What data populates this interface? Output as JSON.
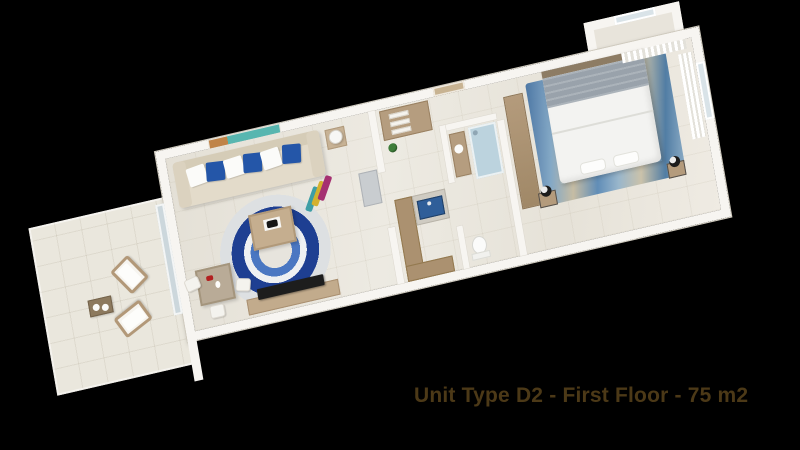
{
  "caption": {
    "text": "Unit Type D2 - First Floor - 75 m2"
  },
  "palette": {
    "background": "#000000",
    "wall": "#f7f5f1",
    "floor": "#e8e4db",
    "terrace_floor": "#eae7dd",
    "wood": "#b59d7f",
    "glass": "#ccd7dc",
    "accent_blue": "#2456a8",
    "rug_blue_dark": "#1e3f92",
    "rug_blue_mid": "#4a77c2",
    "kitchen_blue": "#2f5e99",
    "shower_blue": "#bcd3de",
    "bed_blanket_grey": "#99a2ab",
    "painting_teal": "#58b6b0",
    "painting_orange": "#c08448",
    "caption_color": "#4c3917"
  }
}
